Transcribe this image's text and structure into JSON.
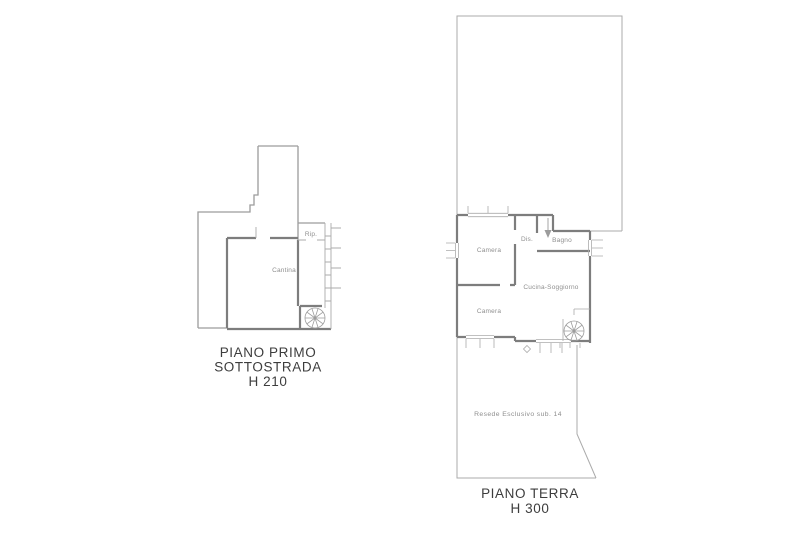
{
  "drawing": {
    "background": "#ffffff",
    "wall_color": "#7d7d7d",
    "line_color": "#9c9c9c",
    "thin_color": "#ababab",
    "label_color": "#8f8f8f",
    "title_color": "#3d3d3d"
  },
  "left_plan": {
    "rooms": {
      "rip": "Rip.",
      "cantina": "Cantina"
    },
    "title_lines": [
      "PIANO PRIMO",
      "SOTTOSTRADA",
      "H 210"
    ]
  },
  "right_plan": {
    "rooms": {
      "camera_top": "Camera",
      "dis": "Dis.",
      "bagno": "Bagno",
      "cucina_soggiorno": "Cucina-Soggiorno",
      "camera_bottom": "Camera"
    },
    "outdoor_area": "Resede Esclusivo sub. 14",
    "title_lines": [
      "PIANO TERRA",
      "H 300"
    ]
  }
}
